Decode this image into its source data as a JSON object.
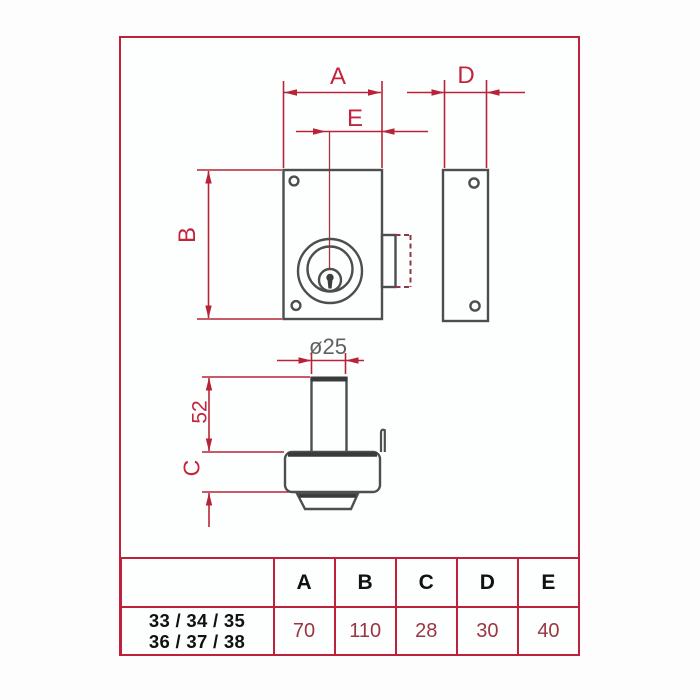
{
  "drawing": {
    "title": "rim-lock dimension drawing",
    "dim_labels": {
      "A": "A",
      "B": "B",
      "C": "C",
      "D": "D",
      "E": "E",
      "diameter": "ø25",
      "cylinder_length": "52"
    }
  },
  "table": {
    "headers": [
      "A",
      "B",
      "C",
      "D",
      "E"
    ],
    "row_label": [
      "33 / 34 / 35",
      "36 / 37 / 38"
    ],
    "values": [
      "70",
      "110",
      "28",
      "30",
      "40"
    ]
  },
  "colors": {
    "accent_border": "#c0213a",
    "dimension_red": "#c3243c",
    "diameter_gray": "#5f5f5f",
    "drawing_gray": "#4e4e4e",
    "dashed_maroon": "#8e3a44",
    "table_value": "#9a3640",
    "table_header": "#111111"
  }
}
